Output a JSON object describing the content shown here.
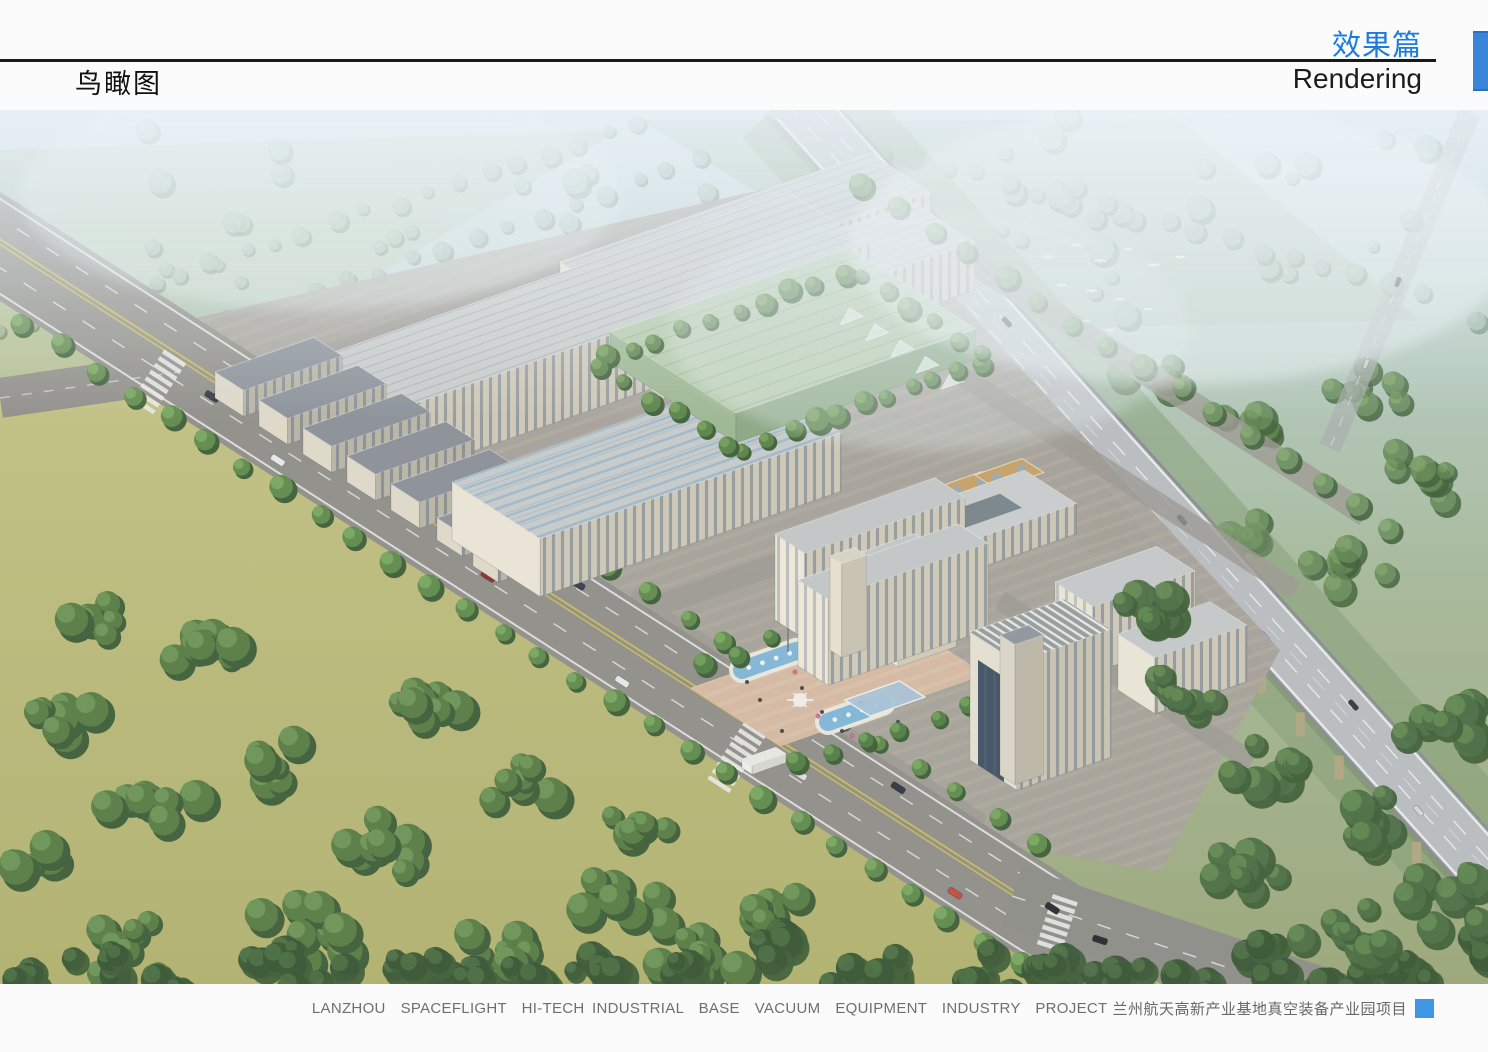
{
  "header": {
    "section_title_zh": "效果篇",
    "section_title_en": "Rendering",
    "page_title_zh": "鸟瞰图",
    "accent_color": "#1b7ce0",
    "accent_bar_color": "#3a85d8"
  },
  "figure": {
    "alt": "Aerial bird's-eye rendering of an industrial park with factory halls, a green glass workshop, office buildings, a plaza with fountain pools and an elevated expressway"
  },
  "footer": {
    "caption_en": "LANZHOU  SPACEFLIGHT  HI-TECH INDUSTRIAL  BASE  VACUUM  EQUIPMENT  INDUSTRY  PROJECT",
    "caption_zh": "兰州航天高新产业基地真空装备产业园项目",
    "caption_color": "#6f6f6f",
    "square_color": "#3e97e4"
  }
}
